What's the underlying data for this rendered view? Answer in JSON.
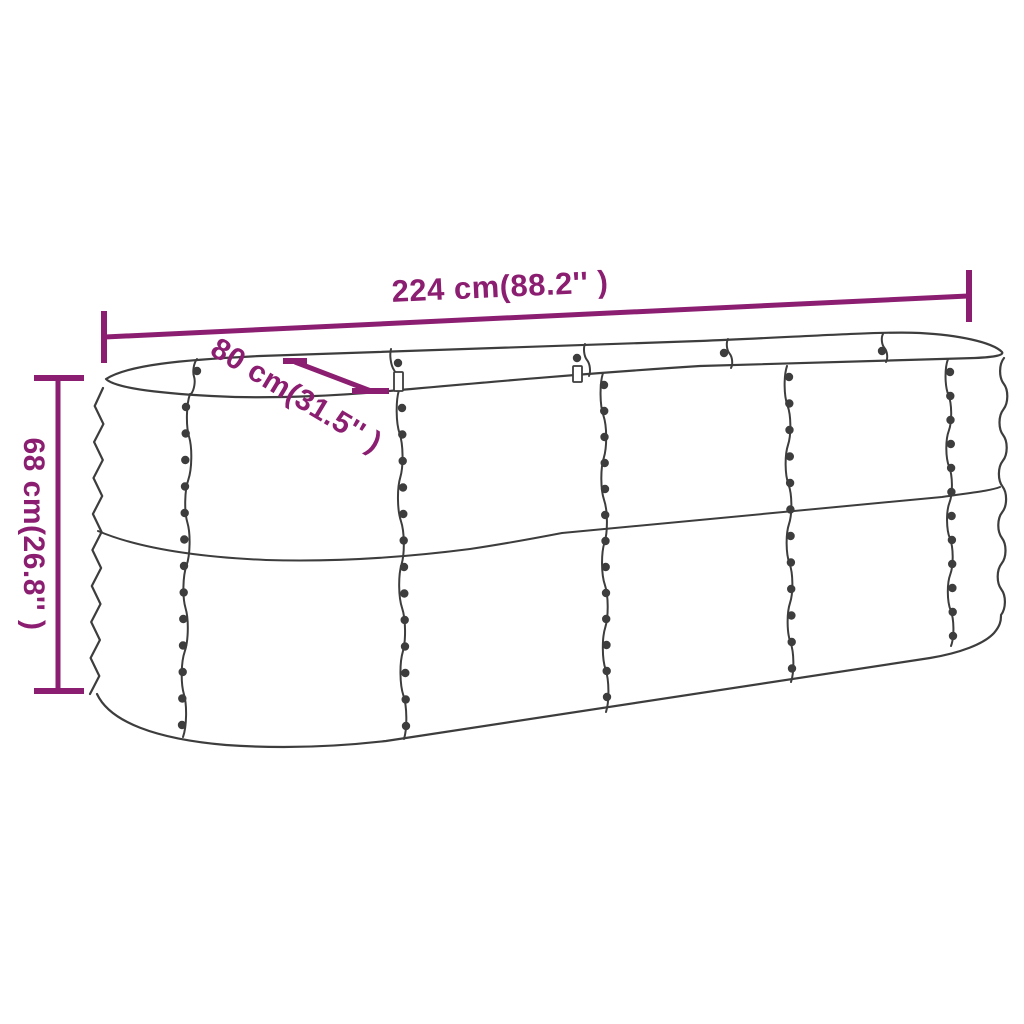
{
  "figure": {
    "description": "Line drawing of an oval corrugated-metal raised garden bed with riveted panel seams and rim clips, annotated with overall dimensions"
  },
  "colors": {
    "dimension_annotations": "#8b1e70",
    "line_art": "#3d3d3d",
    "background": "#ffffff"
  },
  "dimensions": {
    "length": {
      "label": "224 cm(88.2'' )",
      "cm": "224",
      "inches": "88.2"
    },
    "width": {
      "label": "80 cm(31.5'' )",
      "cm": "80",
      "inches": "31.5"
    },
    "height": {
      "label": "68 cm(26.8'' )",
      "cm": "68",
      "inches": "26.8"
    }
  }
}
